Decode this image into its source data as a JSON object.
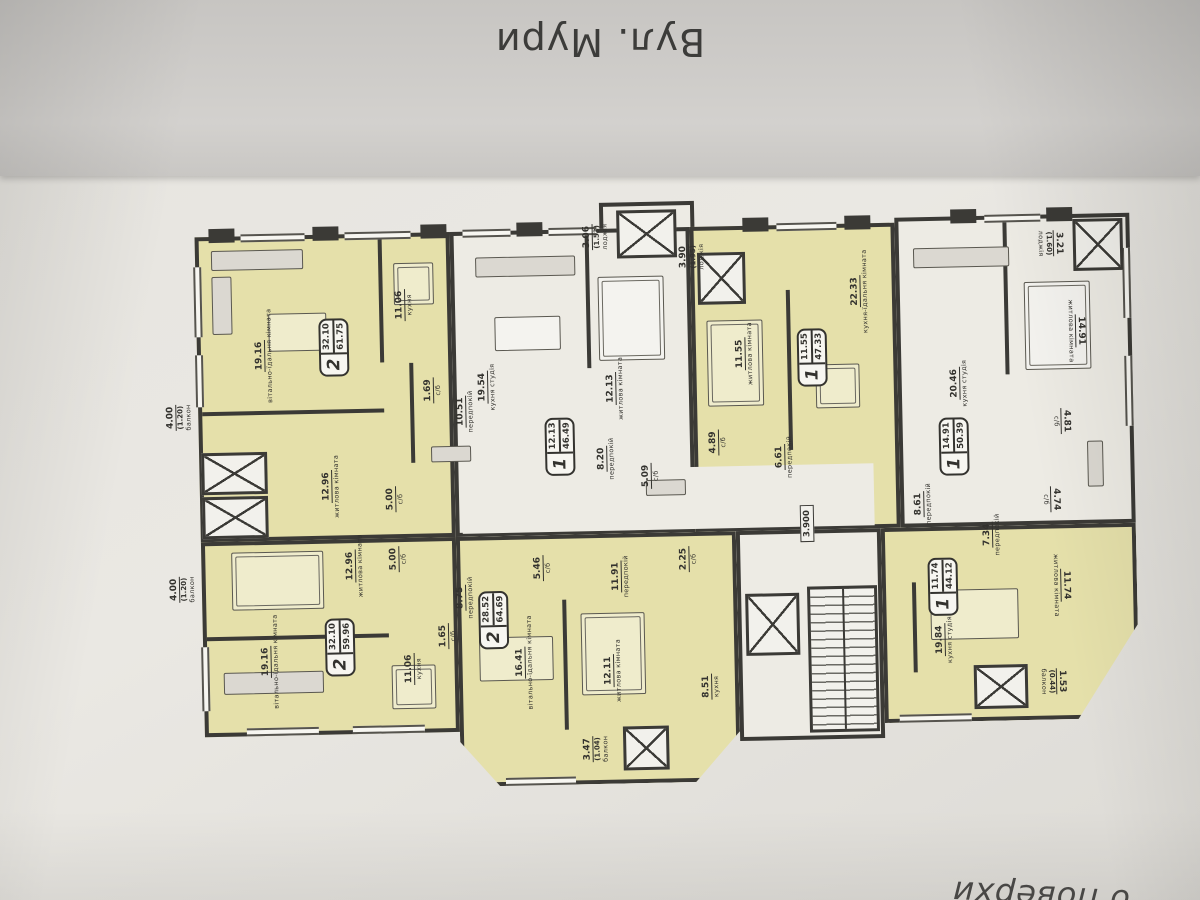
{
  "photo": {
    "street_label": "Вул. Мури",
    "bottom_caption_fragment": "о поверхи"
  },
  "core": {
    "level_mark": "3.900"
  },
  "apartments": [
    {
      "id": "A",
      "badge": {
        "rooms": "2",
        "living_area": "32.10",
        "total_area": "61.75"
      },
      "rooms": [
        {
          "name": "вітально-їдальня кімната",
          "area": "19.16"
        },
        {
          "name": "кухня",
          "area": "11.06"
        },
        {
          "name": "житлова кімната",
          "area": "12.96"
        },
        {
          "name": "передпокій",
          "area": "10.51"
        },
        {
          "name": "с/б",
          "area": "5.00"
        },
        {
          "name": "с/б",
          "area": "1.69"
        },
        {
          "name": "балкон",
          "area": "4.00",
          "area_reduced": "(1.20)"
        }
      ]
    },
    {
      "id": "B",
      "badge": {
        "rooms": "1",
        "living_area": "12.13",
        "total_area": "46.49"
      },
      "rooms": [
        {
          "name": "кухня студія",
          "area": "19.54"
        },
        {
          "name": "житлова кімната",
          "area": "12.13"
        },
        {
          "name": "передпокій",
          "area": "8.20"
        },
        {
          "name": "с/б",
          "area": "5.09"
        },
        {
          "name": "лоджія",
          "area": "3.06",
          "area_reduced": "(1.53)"
        }
      ]
    },
    {
      "id": "C",
      "badge": {
        "rooms": "1",
        "living_area": "11.55",
        "total_area": "47.33"
      },
      "rooms": [
        {
          "name": "кухня-їдальня кімната",
          "area": "22.33"
        },
        {
          "name": "житлова кімната",
          "area": "11.55"
        },
        {
          "name": "передпокій",
          "area": "6.61"
        },
        {
          "name": "с/б",
          "area": "4.89"
        },
        {
          "name": "лоджія",
          "area": "3.90",
          "area_reduced": "(1.95)"
        }
      ]
    },
    {
      "id": "D",
      "badge": {
        "rooms": "1",
        "living_area": "14.91",
        "total_area": "50.39"
      },
      "rooms": [
        {
          "name": "кухня студія",
          "area": "20.46"
        },
        {
          "name": "житлова кімната",
          "area": "14.91"
        },
        {
          "name": "передпокій",
          "area": "8.61"
        },
        {
          "name": "с/б",
          "area": "4.81"
        },
        {
          "name": "лоджія",
          "area": "3.21",
          "area_reduced": "(1.60)"
        }
      ]
    },
    {
      "id": "E",
      "badge": {
        "rooms": "1",
        "living_area": "11.74",
        "total_area": "44.12"
      },
      "rooms": [
        {
          "name": "кухня студія",
          "area": "19.84"
        },
        {
          "name": "житлова кімната",
          "area": "11.74"
        },
        {
          "name": "передпокій",
          "area": "7.34"
        },
        {
          "name": "с/б",
          "area": "4.74"
        },
        {
          "name": "балкон",
          "area": "1.53",
          "area_reduced": "(0.44)"
        }
      ]
    },
    {
      "id": "F",
      "badge": {
        "rooms": "2",
        "living_area": "28.52",
        "total_area": "64.69"
      },
      "rooms": [
        {
          "name": "вітально-їдальня кімната",
          "area": "16.41"
        },
        {
          "name": "житлова кімната",
          "area": "12.11"
        },
        {
          "name": "кухня",
          "area": "8.51"
        },
        {
          "name": "передпокій",
          "area": "11.91"
        },
        {
          "name": "с/б",
          "area": "5.46"
        },
        {
          "name": "с/б",
          "area": "2.25"
        },
        {
          "name": "балкон",
          "area": "3.47",
          "area_reduced": "(1.04)"
        }
      ]
    },
    {
      "id": "G",
      "badge": {
        "rooms": "2",
        "living_area": "32.10",
        "total_area": "59.96"
      },
      "rooms": [
        {
          "name": "вітально-їдальня кімната",
          "area": "19.16"
        },
        {
          "name": "кухня",
          "area": "11.06"
        },
        {
          "name": "житлова кімната",
          "area": "12.96"
        },
        {
          "name": "с/б",
          "area": "5.00"
        },
        {
          "name": "передпокій",
          "area": "8.75"
        },
        {
          "name": "с/б",
          "area": "1.65"
        },
        {
          "name": "балкон",
          "area": "4.00",
          "area_reduced": "(1.20)"
        }
      ]
    }
  ]
}
